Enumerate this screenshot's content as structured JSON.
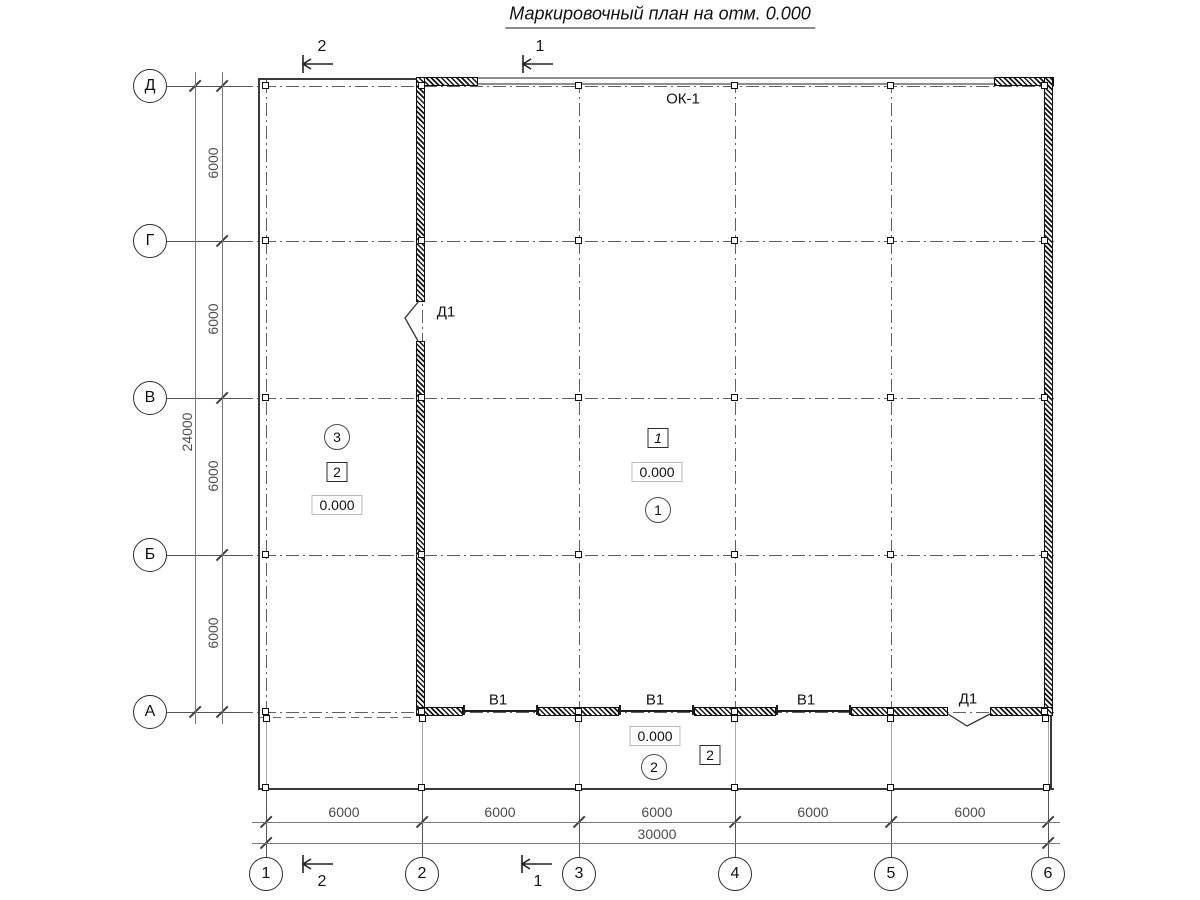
{
  "title": "Маркировочный план на отм. 0.000",
  "axes": {
    "row_labels": [
      "Д",
      "Г",
      "В",
      "Б",
      "А"
    ],
    "col_labels": [
      "1",
      "2",
      "3",
      "4",
      "5",
      "6"
    ]
  },
  "dims": {
    "v_segments": [
      "6000",
      "6000",
      "6000",
      "6000"
    ],
    "v_total": "24000",
    "h_segments": [
      "6000",
      "6000",
      "6000",
      "6000",
      "6000"
    ],
    "h_total": "30000"
  },
  "sections": {
    "s2": "2",
    "s1": "1"
  },
  "openings": {
    "window": "ОК-1",
    "left_door": "Д1",
    "bottom_door": "Д1",
    "gate": "В1"
  },
  "rooms": {
    "circle_left": "3",
    "circle_center": "1",
    "circle_bottom": "2",
    "box_left": "2",
    "box_center": "1",
    "box_bottom": "2",
    "elevation": "0.000"
  },
  "colors": {
    "line": "#333333",
    "hatch": "#111111",
    "window_band": "#8f8f8f"
  }
}
